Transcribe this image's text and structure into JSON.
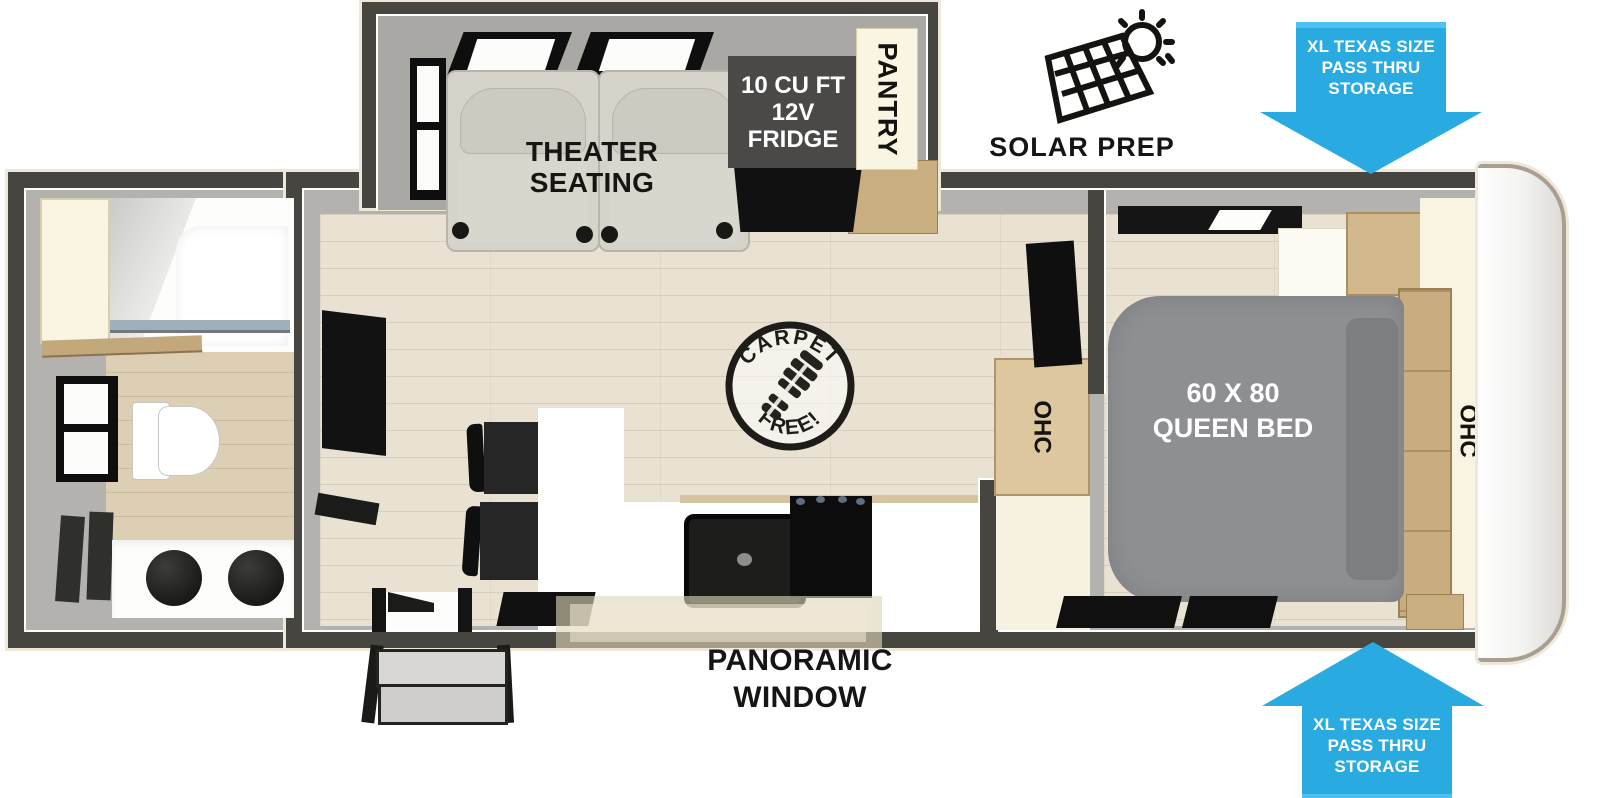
{
  "slideout": {
    "line1": "THEATER",
    "line2": "SEATING"
  },
  "fridge": {
    "line1": "10 CU FT",
    "line2": "12V",
    "line3": "FRIDGE"
  },
  "pantry": {
    "label": "PANTRY"
  },
  "solar": {
    "label": "SOLAR PREP"
  },
  "storage_top": {
    "line1": "XL TEXAS SIZE",
    "line2": "PASS THRU",
    "line3": "STORAGE"
  },
  "storage_bottom": {
    "line1": "XL TEXAS SIZE",
    "line2": "PASS THRU",
    "line3": "STORAGE"
  },
  "bed": {
    "line1": "60 X 80",
    "line2": "QUEEN BED"
  },
  "cabinets": {
    "bedroom_ohc": "OHC",
    "kitchen_ohc": "OHC"
  },
  "badge": {
    "top": "CARPET",
    "bottom": "FREE!"
  },
  "panoramic": {
    "line1": "PANORAMIC",
    "line2": "WINDOW"
  },
  "colors": {
    "accent_blue": "#29ABE2",
    "wall_dark": "#474540",
    "bed_gray": "#8d8f92",
    "floor_beige": "#e9e2d3"
  }
}
